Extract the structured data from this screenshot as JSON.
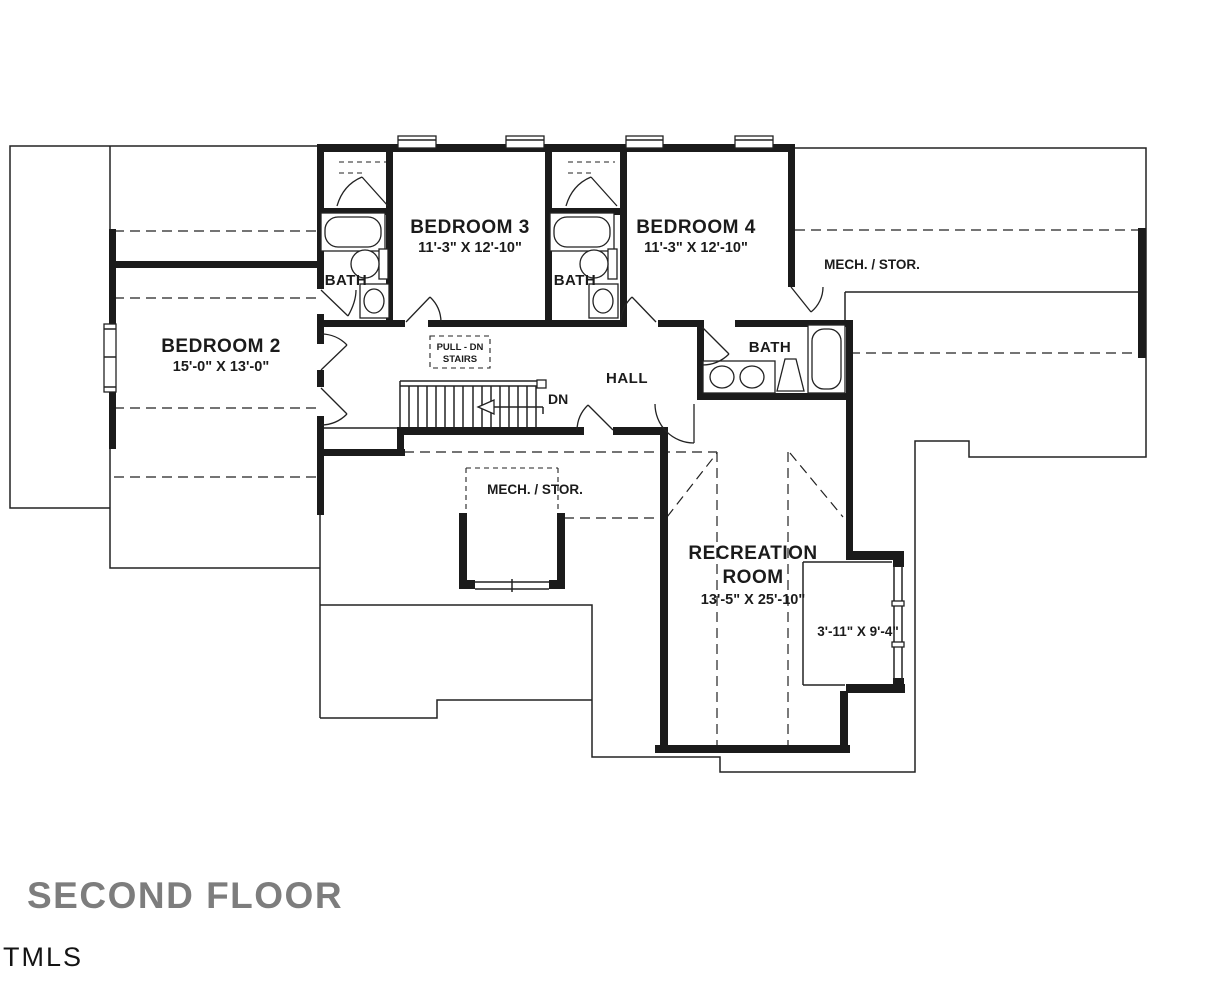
{
  "title": "SECOND FLOOR",
  "watermark": "TMLS",
  "rooms": {
    "bedroom2": {
      "name": "BEDROOM 2",
      "dims": "15'-0\" X 13'-0\""
    },
    "bedroom3": {
      "name": "BEDROOM 3",
      "dims": "11'-3\" X 12'-10\""
    },
    "bedroom4": {
      "name": "BEDROOM 4",
      "dims": "11'-3\" X 12'-10\""
    },
    "recreation": {
      "line1": "RECREATION",
      "line2": "ROOM",
      "dims": "13'-5\" X 25'-10\""
    },
    "hall": {
      "name": "HALL"
    },
    "bath_left": {
      "name": "BATH"
    },
    "bath_middle": {
      "name": "BATH"
    },
    "bath_hall": {
      "name": "BATH"
    },
    "mech_stor_attic": {
      "name": "MECH. / STOR."
    },
    "mech_stor_closet": {
      "name": "MECH. / STOR."
    },
    "alcove": {
      "dims": "3'-11\" X 9'-4\""
    }
  },
  "stairs": {
    "pull_line1": "PULL - DN",
    "pull_line2": "STAIRS",
    "down_label": "DN"
  },
  "colors": {
    "wall": "#1b1b1b",
    "line": "#222222",
    "title_text": "#7d7d7d",
    "watermark_text": "#141414"
  }
}
